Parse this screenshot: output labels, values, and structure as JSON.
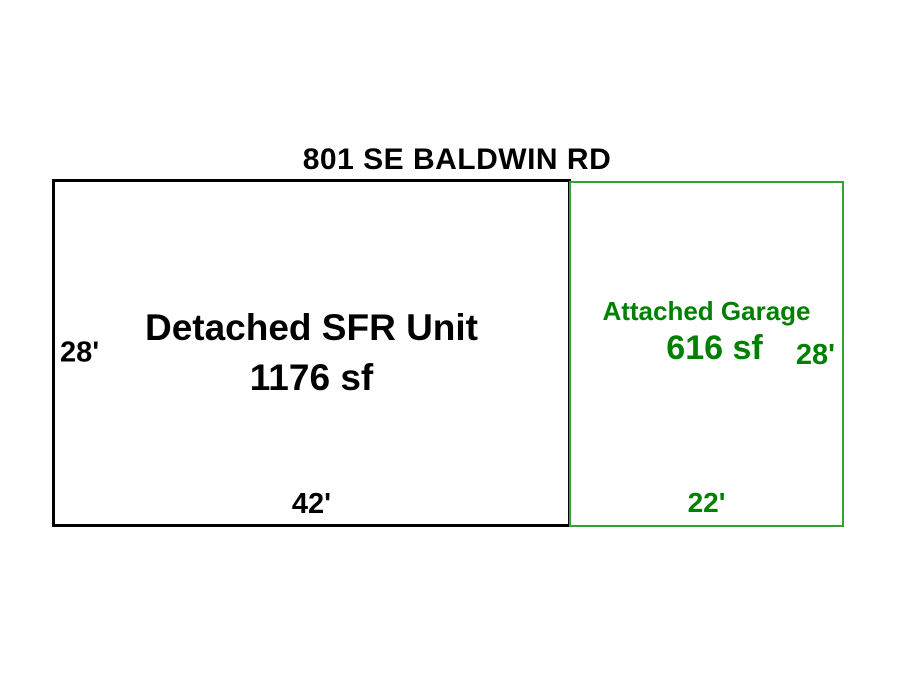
{
  "title": "801 SE BALDWIN RD",
  "colors": {
    "ink": "#000000",
    "garage_text": "#008000",
    "garage_border": "#35a035",
    "background": "#ffffff"
  },
  "detached_unit": {
    "name": "Detached SFR Unit",
    "area": "1176 sf",
    "side_dimension": "28'",
    "bottom_dimension": "42'"
  },
  "attached_garage": {
    "name": "Attached Garage",
    "area": "616 sf",
    "side_dimension": "28'",
    "bottom_dimension": "22'"
  }
}
